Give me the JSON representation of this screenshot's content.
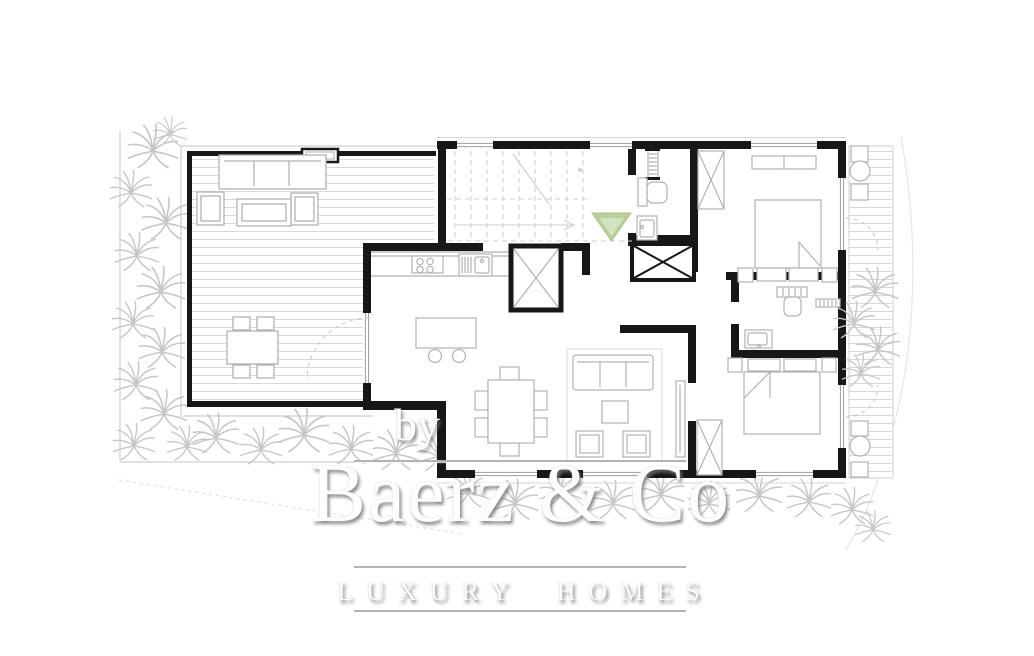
{
  "watermark": {
    "by_label": "by",
    "brand_name": "Baerz & Co",
    "tagline": "LUXURY HOMES",
    "text_color": "#fdfdfd",
    "shadow_color": "#9a9a9a",
    "rule_color": "#b3b3b3"
  },
  "floorplan": {
    "wall_color": "#171717",
    "furniture_line_color": "#b2b2b2",
    "decking_line_color": "#d8d8d8",
    "vegetation_color": "#c7c7c7",
    "window_line_color": "#9c9c9c",
    "boundary_line_color": "#cfcfcf",
    "entrance_marker_color": "#b7d095",
    "entrance_marker_inner_color": "#d4e3bf"
  }
}
